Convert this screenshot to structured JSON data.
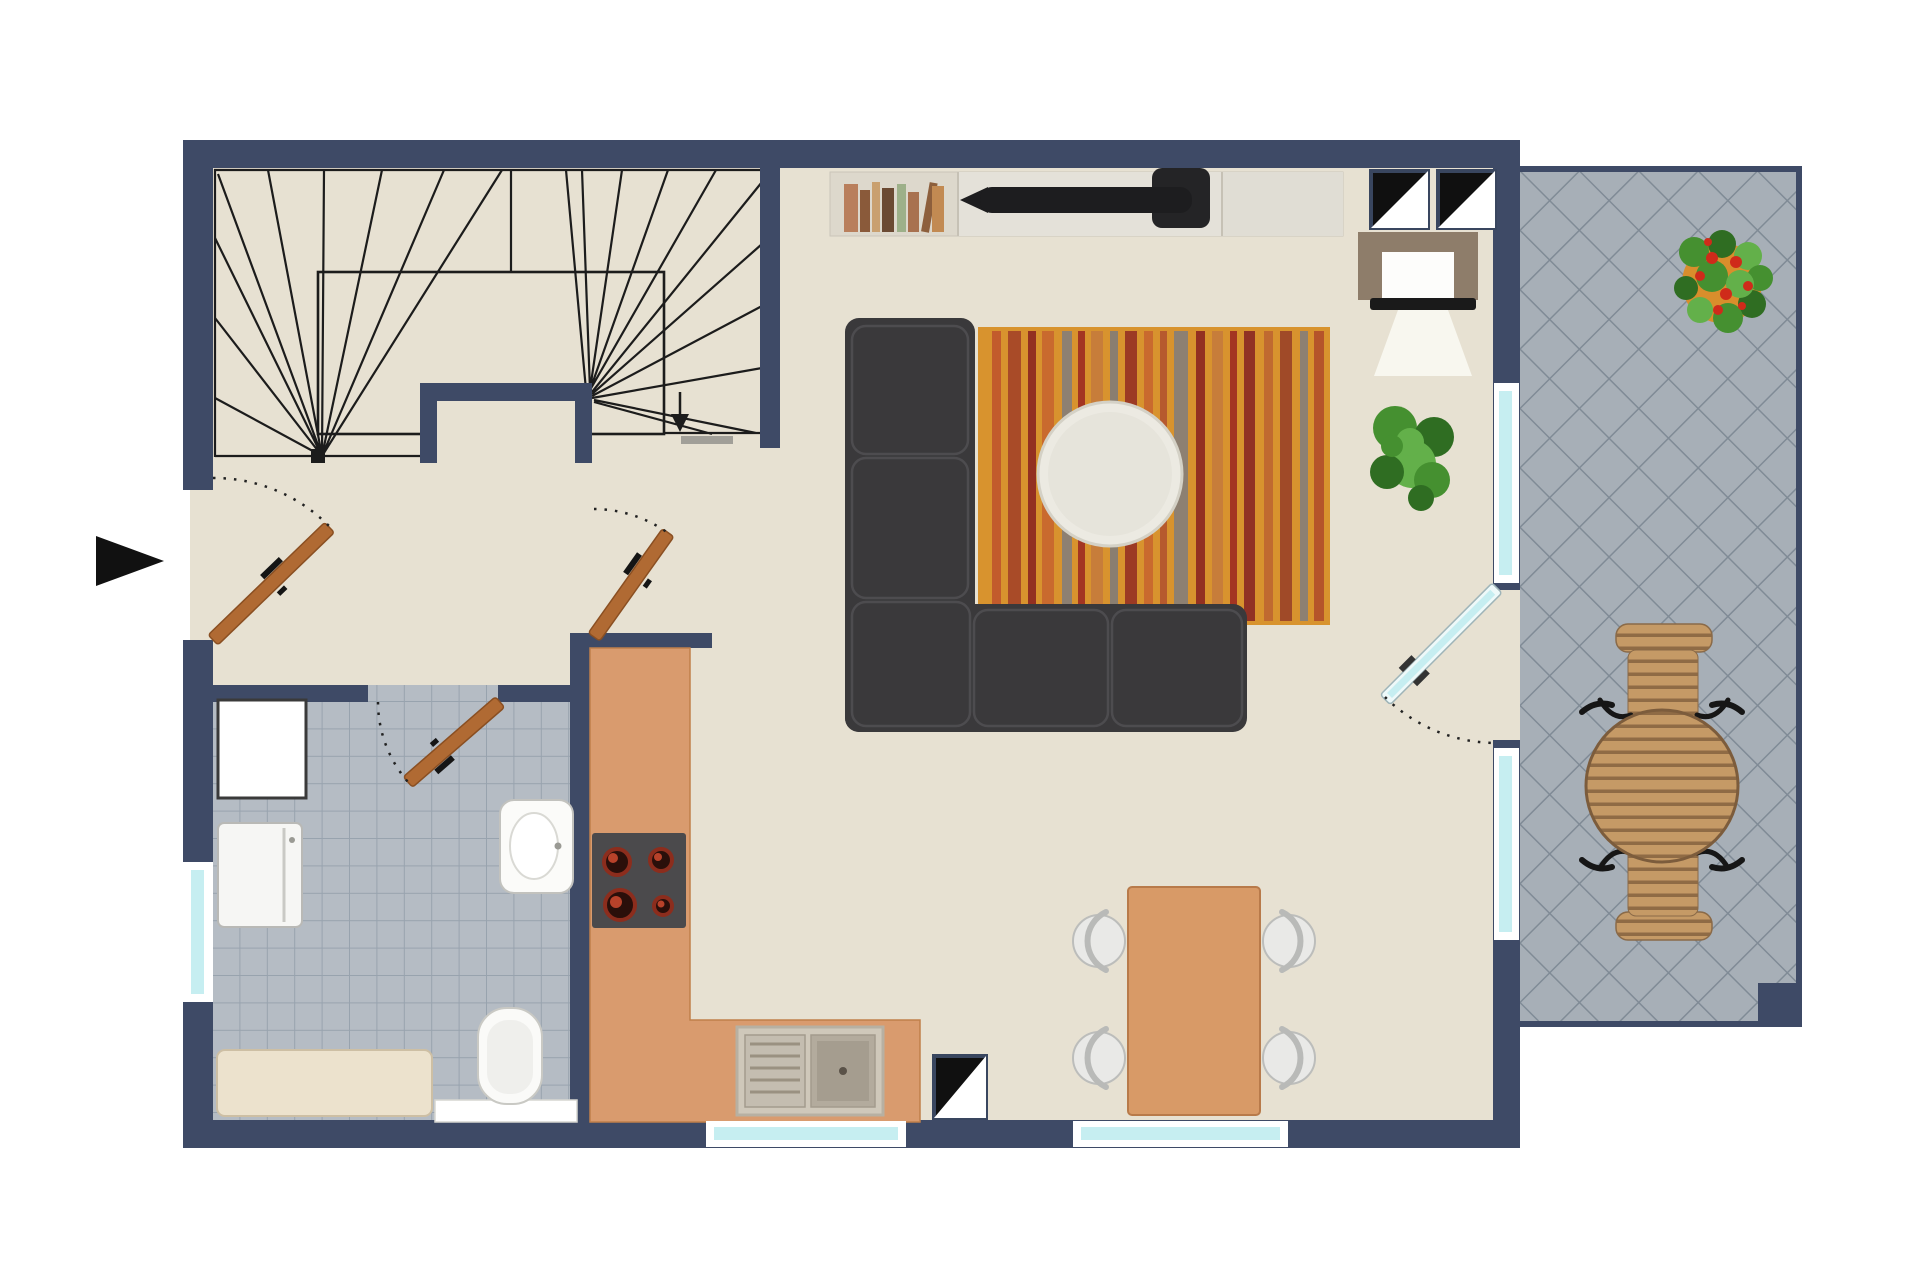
{
  "scene": {
    "type": "apartment-floor-plan-top-view",
    "rooms": [
      "staircase",
      "entry-hall",
      "bathroom",
      "kitchen",
      "living-room",
      "dining-area",
      "balcony"
    ],
    "furniture": [
      "sideboard-with-books",
      "flat-tv",
      "armchair-with-reading-light",
      "potted-plant",
      "striped-rug",
      "corner-sofa",
      "round-coffee-table",
      "dining-table-four-chairs",
      "l-shaped-kitchen-counter",
      "four-burner-cooktop",
      "double-kitchen-sink",
      "shower-square",
      "washing-machine",
      "washbasin",
      "toilet",
      "bathtub",
      "balcony-slat-table",
      "balcony-chairs",
      "flower-planter"
    ],
    "annotations": [
      "entrance-arrow-left",
      "stair-direction-arrow",
      "three-diagonal-shaft-symbols",
      "four-swing-doors-with-dotted-arcs",
      "cyan-windows"
    ]
  },
  "colors": {
    "wall": "#3e4a66",
    "floor": "#e7e1d2",
    "bath_tile": "#b5bcc4",
    "bath_grout": "#98a3ae",
    "balc_tile": "#a7afb7",
    "balc_grout": "#808b96",
    "stair_line": "#1c1c1c",
    "door": "#b06a33",
    "door_edge": "#8a4f22",
    "glass": "#c6eef1",
    "counter": "#d99b6e",
    "stove": "#4b4a4c",
    "rug": "#d8932e",
    "sofa": "#3a393b",
    "coffee_table": "#eceae2",
    "dining_table": "#d89a67",
    "chair": "#e9e9e7",
    "wood_slat": "#c59a66",
    "wood_gap": "#8f6b45",
    "armchair": "#8e7d6a",
    "beam": "#faf8f1",
    "pot": "#d98e2c",
    "flower": "#cf2b1a",
    "plant_dark": "#2f6d22",
    "plant_mid": "#459030",
    "plant_light": "#63b04a",
    "tv": "#1d1d1f",
    "sideboard": "#ddd8cc",
    "sideboard2": "#e4e1d9",
    "steel": "#cfc8ba",
    "tub": "#ece2cd",
    "symbol_black": "#101010",
    "white": "#ffffff"
  },
  "rug": {
    "x": 978,
    "y": 327,
    "w": 352,
    "h": 298,
    "stripes": [
      {
        "dx": 14,
        "w": 9,
        "c": "#c25b2c"
      },
      {
        "dx": 30,
        "w": 13,
        "c": "#a94b28"
      },
      {
        "dx": 50,
        "w": 8,
        "c": "#933021"
      },
      {
        "dx": 64,
        "w": 12,
        "c": "#c96a2e"
      },
      {
        "dx": 84,
        "w": 10,
        "c": "#8d8072"
      },
      {
        "dx": 100,
        "w": 7,
        "c": "#a33522"
      },
      {
        "dx": 113,
        "w": 12,
        "c": "#c77d3a"
      },
      {
        "dx": 132,
        "w": 8,
        "c": "#8a7e70"
      },
      {
        "dx": 147,
        "w": 12,
        "c": "#9c3a24"
      },
      {
        "dx": 166,
        "w": 9,
        "c": "#c96a2e"
      },
      {
        "dx": 182,
        "w": 7,
        "c": "#b65a2e"
      },
      {
        "dx": 196,
        "w": 14,
        "c": "#8d8072"
      },
      {
        "dx": 218,
        "w": 9,
        "c": "#933021"
      },
      {
        "dx": 234,
        "w": 11,
        "c": "#c77d3a"
      },
      {
        "dx": 252,
        "w": 7,
        "c": "#a33522"
      },
      {
        "dx": 266,
        "w": 11,
        "c": "#913224"
      },
      {
        "dx": 286,
        "w": 9,
        "c": "#c06a30"
      },
      {
        "dx": 302,
        "w": 12,
        "c": "#a04a28"
      },
      {
        "dx": 322,
        "w": 8,
        "c": "#8d8072"
      },
      {
        "dx": 336,
        "w": 10,
        "c": "#b5542a"
      }
    ]
  },
  "books": [
    {
      "dx": 14,
      "w": 14,
      "h": 48,
      "c": "#b97f5c"
    },
    {
      "dx": 30,
      "w": 10,
      "h": 42,
      "c": "#8a5a3a"
    },
    {
      "dx": 42,
      "w": 8,
      "h": 50,
      "c": "#c9a06f"
    },
    {
      "dx": 52,
      "w": 12,
      "h": 44,
      "c": "#6b4a33"
    },
    {
      "dx": 67,
      "w": 9,
      "h": 48,
      "c": "#9db089"
    },
    {
      "dx": 78,
      "w": 11,
      "h": 40,
      "c": "#a8714f"
    },
    {
      "dx": 91,
      "w": 8,
      "h": 50,
      "c": "#8d5f3c",
      "r": 10
    },
    {
      "dx": 102,
      "w": 12,
      "h": 46,
      "c": "#c28a52"
    }
  ]
}
